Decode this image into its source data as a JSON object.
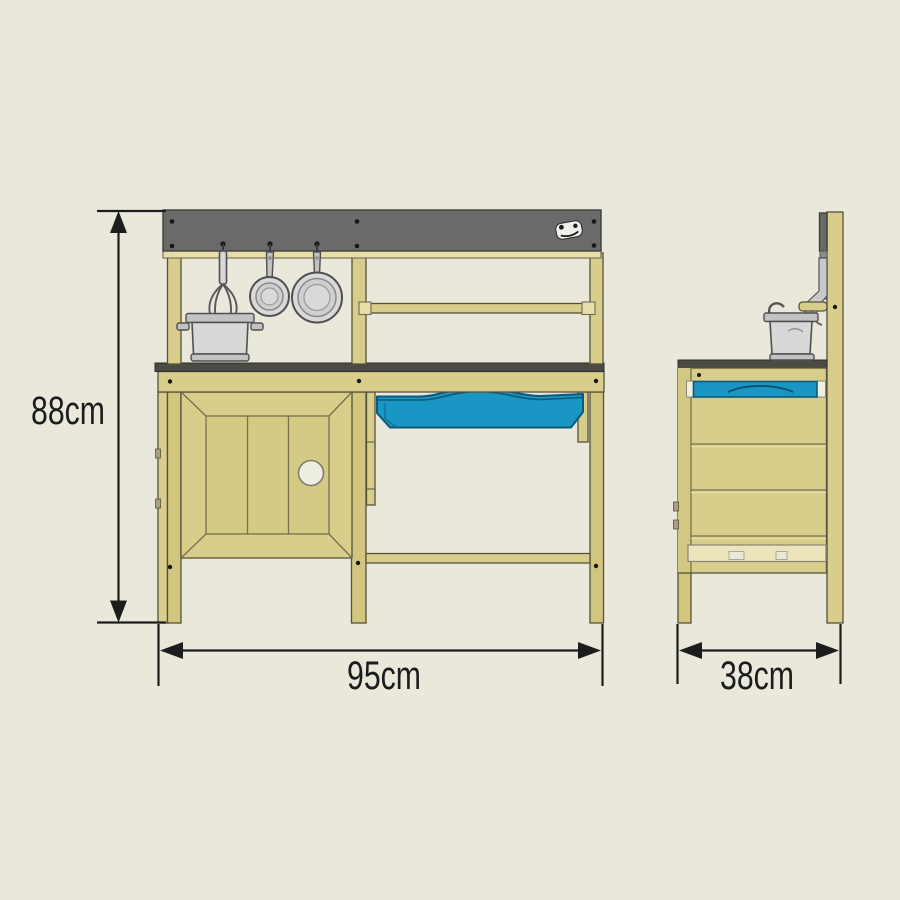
{
  "figure": {
    "background": "#e9e8db",
    "dimensions": {
      "height": {
        "text": "88cm",
        "value": 88,
        "unit": "cm"
      },
      "width": {
        "text": "95cm",
        "value": 95,
        "unit": "cm"
      },
      "depth": {
        "text": "38cm",
        "value": 38,
        "unit": "cm"
      }
    },
    "colors": {
      "wood": "#d8cd8a",
      "wood_light": "#e7dea8",
      "header_gray": "#6a6a6a",
      "counter_gray": "#4b4b44",
      "basin_blue": "#1a96c4",
      "metal": "#d8d8d8",
      "dimension_line": "#1d1d1d"
    },
    "icons": {
      "brand_logo": "brand-logo-icon"
    }
  }
}
